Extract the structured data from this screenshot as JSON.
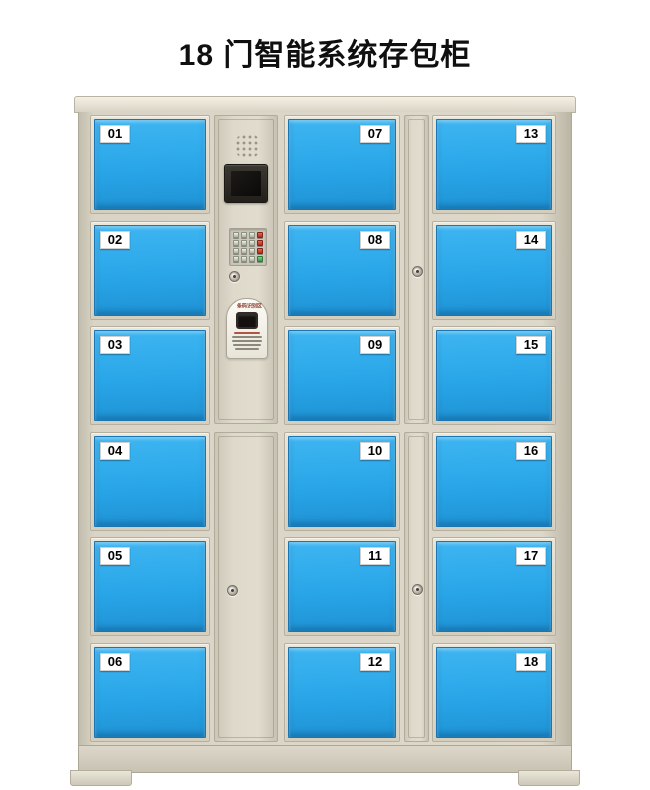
{
  "page": {
    "title": "18 门智能系统存包柜",
    "background_color": "#ffffff"
  },
  "cabinet": {
    "door_count": "18",
    "colors": {
      "body_cream": "#d9d4c5",
      "door_blue": "#29a6e8",
      "badge_bg": "#ffffff",
      "badge_text": "#000000",
      "keypad_red": "#c0392b",
      "keypad_green": "#3f9e4d",
      "screen_black": "#14110e"
    },
    "columns": {
      "left": [
        "01",
        "02",
        "03",
        "04",
        "05",
        "06"
      ],
      "middle": [
        "07",
        "08",
        "09",
        "10",
        "11",
        "12"
      ],
      "right": [
        "13",
        "14",
        "15",
        "16",
        "17",
        "18"
      ]
    },
    "control_panel": {
      "scanner_label": "条码识别区"
    }
  }
}
